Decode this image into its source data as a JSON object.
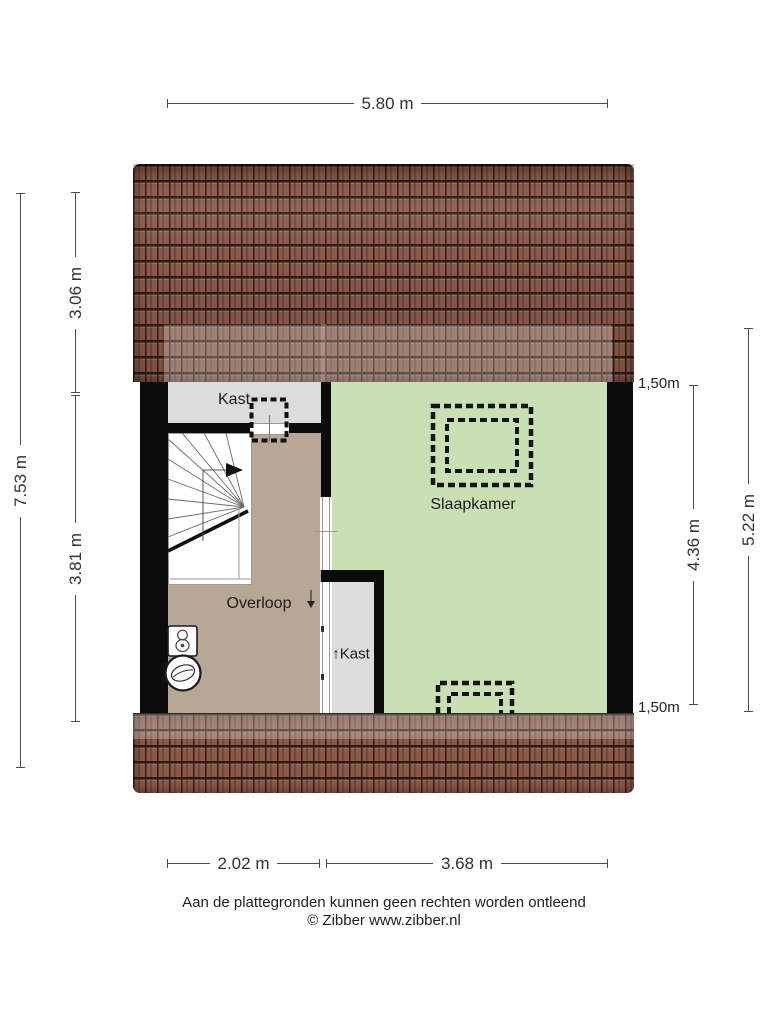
{
  "dimensions": {
    "top_width": "5.80 m",
    "left_total": "7.53 m",
    "left_upper": "3.06 m",
    "left_lower": "3.81 m",
    "right_room": "4.36 m",
    "right_total": "5.22 m",
    "height_marker_top": "1,50m",
    "height_marker_bottom": "1,50m",
    "bottom_left": "2.02 m",
    "bottom_right": "3.68 m"
  },
  "rooms": {
    "closet_top": "Kast",
    "bedroom": "Slaapkamer",
    "landing": "Overloop",
    "closet_bottom": "↑Kast"
  },
  "footer": {
    "disclaimer": "Aan de plattegronden kunnen geen rechten worden ontleend",
    "copyright": "© Zibber www.zibber.nl"
  },
  "colors": {
    "roof_tile": "#8a5a49",
    "wall": "#0b0b0b",
    "bedroom_floor": "#c9dfb4",
    "landing_floor": "#b7a795",
    "closet_floor": "#dcdcdc",
    "dimension": "#4a4a4a",
    "label_text": "#1d1d1d",
    "roof_highlight": "rgba(255,255,255,0.26)"
  }
}
